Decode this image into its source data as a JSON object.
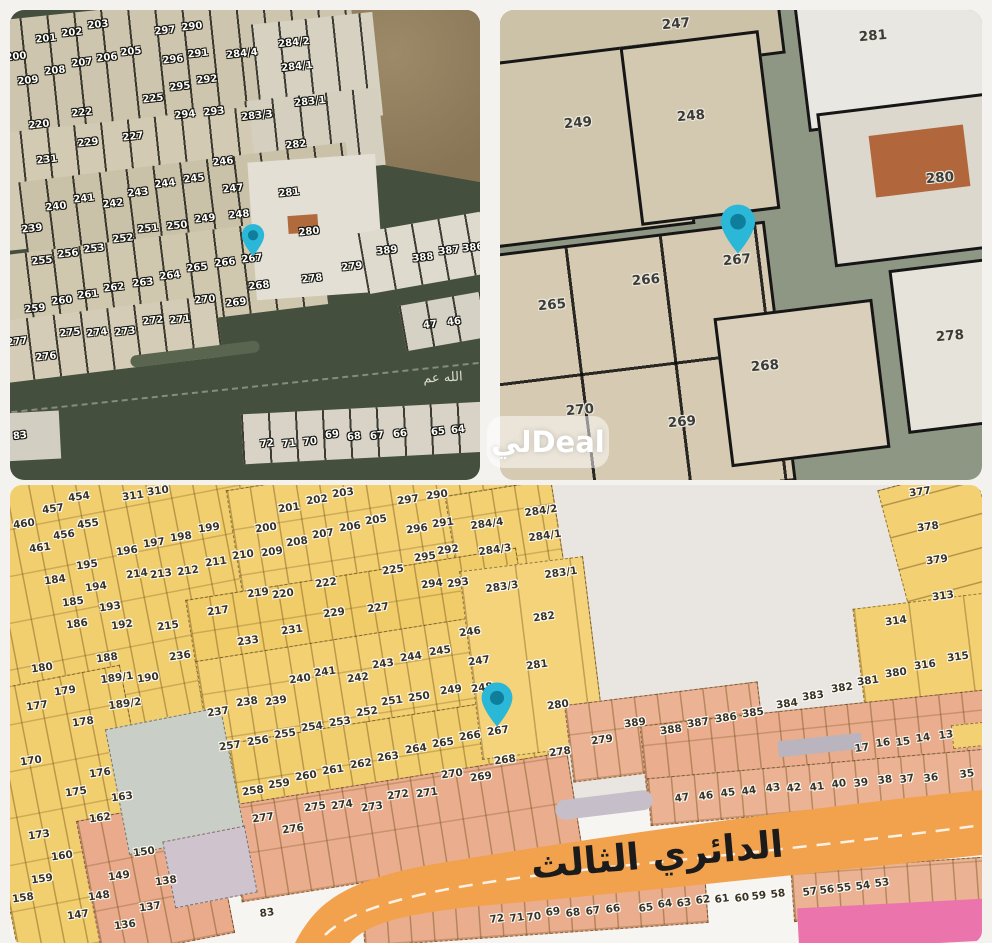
{
  "watermark": {
    "text": "ليDeal"
  },
  "selected_parcel": "267",
  "pin_color": "#2bb7d8",
  "panels": [
    {
      "name": "satellite-overview",
      "street_label": "الله عم",
      "pin": {
        "x": 243,
        "y": 247
      },
      "labels": [
        [
          "201",
          36,
          29
        ],
        [
          "202",
          62,
          23
        ],
        [
          "203",
          88,
          15
        ],
        [
          "297",
          155,
          21
        ],
        [
          "290",
          182,
          17
        ],
        [
          "284/2",
          284,
          33
        ],
        [
          "200",
          6,
          47
        ],
        [
          "208",
          45,
          61
        ],
        [
          "207",
          72,
          53
        ],
        [
          "206",
          97,
          48
        ],
        [
          "205",
          121,
          42
        ],
        [
          "296",
          163,
          50
        ],
        [
          "291",
          188,
          44
        ],
        [
          "284/4",
          232,
          44
        ],
        [
          "209",
          18,
          71
        ],
        [
          "295",
          170,
          77
        ],
        [
          "292",
          197,
          70
        ],
        [
          "284/1",
          287,
          57
        ],
        [
          "283/1",
          300,
          92
        ],
        [
          "283/3",
          247,
          106
        ],
        [
          "220",
          29,
          115
        ],
        [
          "222",
          72,
          103
        ],
        [
          "225",
          143,
          89
        ],
        [
          "294",
          175,
          105
        ],
        [
          "293",
          204,
          102
        ],
        [
          "229",
          78,
          133
        ],
        [
          "227",
          123,
          127
        ],
        [
          "282",
          286,
          135
        ],
        [
          "231",
          37,
          150
        ],
        [
          "246",
          213,
          152
        ],
        [
          "281",
          279,
          183
        ],
        [
          "245",
          184,
          169
        ],
        [
          "244",
          155,
          174
        ],
        [
          "243",
          128,
          183
        ],
        [
          "247",
          223,
          179
        ],
        [
          "240",
          46,
          197
        ],
        [
          "241",
          74,
          189
        ],
        [
          "242",
          103,
          194
        ],
        [
          "248",
          229,
          205
        ],
        [
          "239",
          22,
          219
        ],
        [
          "249",
          195,
          209
        ],
        [
          "250",
          167,
          216
        ],
        [
          "251",
          138,
          219
        ],
        [
          "252",
          113,
          229
        ],
        [
          "280",
          299,
          222
        ],
        [
          "253",
          84,
          239
        ],
        [
          "256",
          58,
          244
        ],
        [
          "255",
          32,
          251
        ],
        [
          "267",
          242,
          249
        ],
        [
          "266",
          215,
          253
        ],
        [
          "265",
          187,
          258
        ],
        [
          "389",
          377,
          241
        ],
        [
          "388",
          413,
          248
        ],
        [
          "387",
          439,
          241
        ],
        [
          "386",
          463,
          238
        ],
        [
          "264",
          160,
          266
        ],
        [
          "263",
          133,
          273
        ],
        [
          "262",
          104,
          278
        ],
        [
          "261",
          78,
          285
        ],
        [
          "260",
          52,
          291
        ],
        [
          "259",
          25,
          299
        ],
        [
          "268",
          249,
          276
        ],
        [
          "269",
          226,
          293
        ],
        [
          "270",
          195,
          290
        ],
        [
          "278",
          302,
          269
        ],
        [
          "279",
          342,
          257
        ],
        [
          "272",
          143,
          311
        ],
        [
          "271",
          170,
          310
        ],
        [
          "275",
          60,
          323
        ],
        [
          "274",
          87,
          323
        ],
        [
          "273",
          115,
          322
        ],
        [
          "277",
          7,
          332
        ],
        [
          "276",
          36,
          347
        ],
        [
          "47",
          420,
          315
        ],
        [
          "46",
          444,
          312
        ],
        [
          "83",
          10,
          426
        ],
        [
          "72",
          257,
          434
        ],
        [
          "71",
          279,
          434
        ],
        [
          "70",
          300,
          432
        ],
        [
          "69",
          322,
          425
        ],
        [
          "68",
          344,
          427
        ],
        [
          "67",
          367,
          426
        ],
        [
          "66",
          390,
          424
        ],
        [
          "65",
          428,
          422
        ],
        [
          "64",
          448,
          420
        ]
      ]
    },
    {
      "name": "satellite-closeup",
      "pin": {
        "x": 238,
        "y": 245
      },
      "labels": [
        [
          "247",
          176,
          14
        ],
        [
          "281",
          373,
          26
        ],
        [
          "249",
          78,
          113
        ],
        [
          "248",
          191,
          106
        ],
        [
          "280",
          440,
          168
        ],
        [
          "265",
          52,
          295
        ],
        [
          "266",
          146,
          270
        ],
        [
          "267",
          237,
          250
        ],
        [
          "268",
          265,
          356
        ],
        [
          "269",
          182,
          412
        ],
        [
          "270",
          80,
          400
        ],
        [
          "278",
          450,
          326
        ]
      ]
    },
    {
      "name": "cadastral-map",
      "road_label": "الدائري الثالث",
      "pin": {
        "x": 487,
        "y": 243
      },
      "labels": [
        [
          "454",
          69,
          12
        ],
        [
          "457",
          43,
          24
        ],
        [
          "455",
          78,
          39
        ],
        [
          "456",
          54,
          50
        ],
        [
          "461",
          30,
          63
        ],
        [
          "460",
          14,
          39
        ],
        [
          "311",
          123,
          11
        ],
        [
          "310",
          148,
          6
        ],
        [
          "196",
          117,
          66
        ],
        [
          "197",
          144,
          58
        ],
        [
          "198",
          171,
          52
        ],
        [
          "199",
          199,
          43
        ],
        [
          "195",
          77,
          80
        ],
        [
          "184",
          45,
          95
        ],
        [
          "194",
          86,
          102
        ],
        [
          "185",
          63,
          117
        ],
        [
          "193",
          100,
          122
        ],
        [
          "186",
          67,
          139
        ],
        [
          "192",
          112,
          140
        ],
        [
          "188",
          97,
          173
        ],
        [
          "180",
          32,
          183
        ],
        [
          "189/1",
          107,
          193
        ],
        [
          "190",
          138,
          193
        ],
        [
          "179",
          55,
          206
        ],
        [
          "189/2",
          115,
          219
        ],
        [
          "177",
          27,
          221
        ],
        [
          "178",
          73,
          237
        ],
        [
          "214",
          127,
          89
        ],
        [
          "213",
          151,
          89
        ],
        [
          "212",
          178,
          86
        ],
        [
          "211",
          206,
          77
        ],
        [
          "210",
          233,
          70
        ],
        [
          "217",
          208,
          126
        ],
        [
          "215",
          158,
          141
        ],
        [
          "233",
          238,
          156
        ],
        [
          "236",
          170,
          171
        ],
        [
          "237",
          208,
          227
        ],
        [
          "200",
          256,
          43
        ],
        [
          "201",
          279,
          23
        ],
        [
          "202",
          307,
          15
        ],
        [
          "203",
          333,
          8
        ],
        [
          "205",
          366,
          35
        ],
        [
          "206",
          340,
          42
        ],
        [
          "207",
          313,
          49
        ],
        [
          "208",
          287,
          57
        ],
        [
          "209",
          262,
          67
        ],
        [
          "297",
          398,
          15
        ],
        [
          "290",
          427,
          10
        ],
        [
          "296",
          407,
          44
        ],
        [
          "291",
          433,
          38
        ],
        [
          "295",
          415,
          72
        ],
        [
          "292",
          438,
          65
        ],
        [
          "225",
          383,
          85
        ],
        [
          "294",
          422,
          99
        ],
        [
          "293",
          448,
          98
        ],
        [
          "284/2",
          531,
          26
        ],
        [
          "284/4",
          477,
          39
        ],
        [
          "284/1",
          535,
          51
        ],
        [
          "284/3",
          485,
          65
        ],
        [
          "283/1",
          551,
          88
        ],
        [
          "283/3",
          492,
          102
        ],
        [
          "219",
          248,
          108
        ],
        [
          "220",
          273,
          109
        ],
        [
          "222",
          316,
          98
        ],
        [
          "229",
          324,
          128
        ],
        [
          "227",
          368,
          123
        ],
        [
          "231",
          282,
          145
        ],
        [
          "246",
          460,
          147
        ],
        [
          "245",
          430,
          166
        ],
        [
          "244",
          401,
          172
        ],
        [
          "247",
          469,
          176
        ],
        [
          "243",
          373,
          179
        ],
        [
          "240",
          290,
          194
        ],
        [
          "241",
          315,
          187
        ],
        [
          "242",
          348,
          193
        ],
        [
          "238",
          237,
          217
        ],
        [
          "239",
          266,
          216
        ],
        [
          "251",
          382,
          216
        ],
        [
          "250",
          409,
          212
        ],
        [
          "249",
          441,
          205
        ],
        [
          "248",
          472,
          203
        ],
        [
          "252",
          357,
          227
        ],
        [
          "253",
          330,
          237
        ],
        [
          "254",
          302,
          242
        ],
        [
          "255",
          275,
          249
        ],
        [
          "256",
          248,
          256
        ],
        [
          "257",
          220,
          261
        ],
        [
          "267",
          488,
          246
        ],
        [
          "266",
          460,
          251
        ],
        [
          "265",
          433,
          258
        ],
        [
          "264",
          406,
          264
        ],
        [
          "263",
          378,
          272
        ],
        [
          "262",
          351,
          279
        ],
        [
          "261",
          323,
          285
        ],
        [
          "260",
          296,
          291
        ],
        [
          "259",
          269,
          299
        ],
        [
          "258",
          243,
          306
        ],
        [
          "282",
          534,
          132
        ],
        [
          "281",
          527,
          180
        ],
        [
          "280",
          548,
          220
        ],
        [
          "277",
          253,
          333
        ],
        [
          "276",
          283,
          344
        ],
        [
          "275",
          305,
          322
        ],
        [
          "274",
          332,
          320
        ],
        [
          "273",
          362,
          322
        ],
        [
          "272",
          388,
          310
        ],
        [
          "271",
          417,
          308
        ],
        [
          "270",
          442,
          289
        ],
        [
          "269",
          471,
          292
        ],
        [
          "268",
          495,
          275
        ],
        [
          "278",
          550,
          267
        ],
        [
          "279",
          592,
          255
        ],
        [
          "389",
          625,
          238
        ],
        [
          "388",
          661,
          245
        ],
        [
          "387",
          688,
          238
        ],
        [
          "386",
          716,
          233
        ],
        [
          "385",
          743,
          228
        ],
        [
          "384",
          777,
          219
        ],
        [
          "383",
          803,
          211
        ],
        [
          "382",
          832,
          203
        ],
        [
          "381",
          858,
          196
        ],
        [
          "380",
          886,
          188
        ],
        [
          "316",
          915,
          180
        ],
        [
          "315",
          948,
          172
        ],
        [
          "314",
          886,
          136
        ],
        [
          "313",
          933,
          111
        ],
        [
          "379",
          927,
          75
        ],
        [
          "378",
          918,
          42
        ],
        [
          "377",
          910,
          7
        ],
        [
          "170",
          21,
          276
        ],
        [
          "176",
          90,
          288
        ],
        [
          "175",
          66,
          307
        ],
        [
          "163",
          112,
          312
        ],
        [
          "162",
          90,
          333
        ],
        [
          "173",
          29,
          350
        ],
        [
          "160",
          52,
          371
        ],
        [
          "159",
          32,
          394
        ],
        [
          "158",
          13,
          413
        ],
        [
          "150",
          134,
          367
        ],
        [
          "149",
          109,
          391
        ],
        [
          "148",
          89,
          411
        ],
        [
          "147",
          68,
          430
        ],
        [
          "138",
          156,
          396
        ],
        [
          "137",
          140,
          422
        ],
        [
          "136",
          115,
          440
        ],
        [
          "17",
          852,
          263
        ],
        [
          "16",
          873,
          258
        ],
        [
          "15",
          893,
          257
        ],
        [
          "14",
          913,
          253
        ],
        [
          "13",
          936,
          250
        ],
        [
          "47",
          672,
          313
        ],
        [
          "46",
          696,
          311
        ],
        [
          "45",
          718,
          308
        ],
        [
          "44",
          739,
          306
        ],
        [
          "43",
          763,
          303
        ],
        [
          "42",
          784,
          303
        ],
        [
          "41",
          807,
          302
        ],
        [
          "40",
          829,
          299
        ],
        [
          "39",
          851,
          298
        ],
        [
          "38",
          875,
          295
        ],
        [
          "37",
          897,
          294
        ],
        [
          "36",
          921,
          293
        ],
        [
          "35",
          957,
          289
        ],
        [
          "83",
          257,
          428
        ],
        [
          "72",
          487,
          434
        ],
        [
          "71",
          507,
          433
        ],
        [
          "70",
          524,
          432
        ],
        [
          "69",
          543,
          427
        ],
        [
          "68",
          563,
          428
        ],
        [
          "67",
          583,
          426
        ],
        [
          "66",
          603,
          424
        ],
        [
          "65",
          636,
          423
        ],
        [
          "64",
          655,
          419
        ],
        [
          "63",
          674,
          418
        ],
        [
          "62",
          693,
          415
        ],
        [
          "61",
          712,
          414
        ],
        [
          "60",
          732,
          413
        ],
        [
          "59",
          749,
          411
        ],
        [
          "58",
          768,
          409
        ],
        [
          "57",
          800,
          407
        ],
        [
          "56",
          817,
          405
        ],
        [
          "55",
          834,
          403
        ],
        [
          "54",
          853,
          401
        ],
        [
          "53",
          872,
          398
        ]
      ]
    }
  ]
}
